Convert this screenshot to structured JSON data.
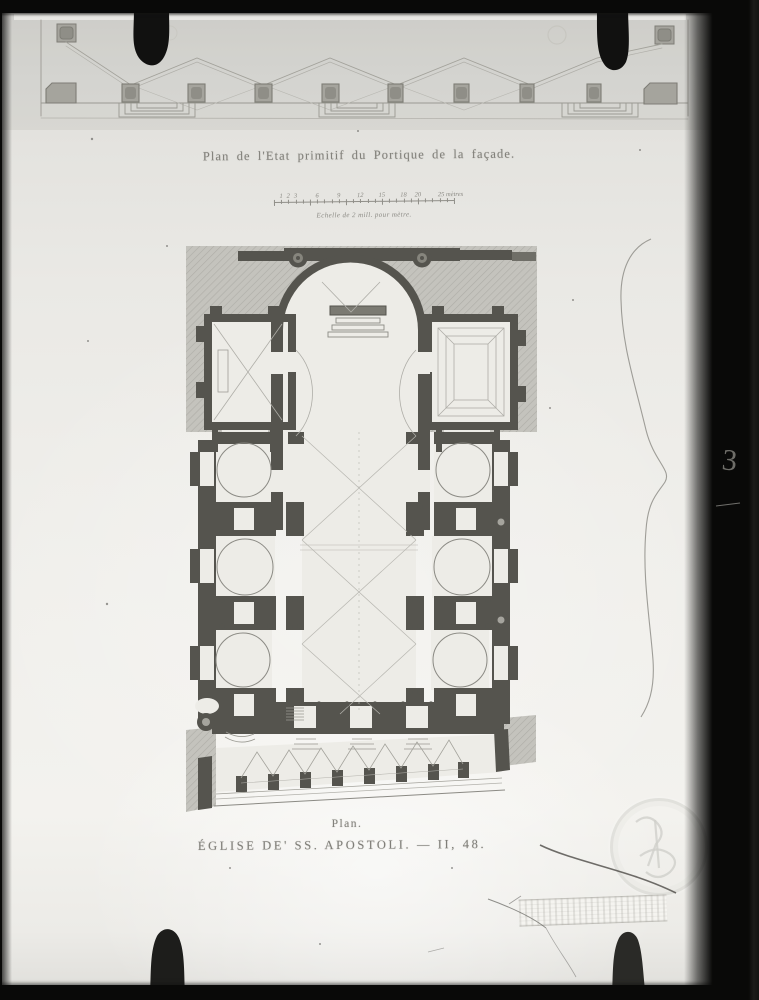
{
  "photo": {
    "description_names": [
      "glass-plate-photograph",
      "portico-strip-plan",
      "church-floor-plan"
    ],
    "colors": {
      "frame_black": "#090908",
      "plate_light": "#efeeea",
      "plan_wall_poche": "#55544e",
      "hatch_background": "#c4c3bd",
      "engraving_line": "#8b8a84",
      "text_ink": "#82817b"
    }
  },
  "engraving": {
    "title": "Plan de l'Etat primitif du Portique de la façade.",
    "scale_bar": {
      "caption": "Echelle de 2 mill. pour mètre.",
      "tick_labels": [
        "1",
        "2",
        "3",
        "6",
        "9",
        "12",
        "15",
        "18",
        "20",
        "25 mètres"
      ]
    },
    "captions": {
      "plan_label": "Plan.",
      "main_caption": "ÉGLISE DE' SS. APOSTOLI. — II, 48."
    }
  },
  "annotations": {
    "handwritten_number": "3"
  }
}
